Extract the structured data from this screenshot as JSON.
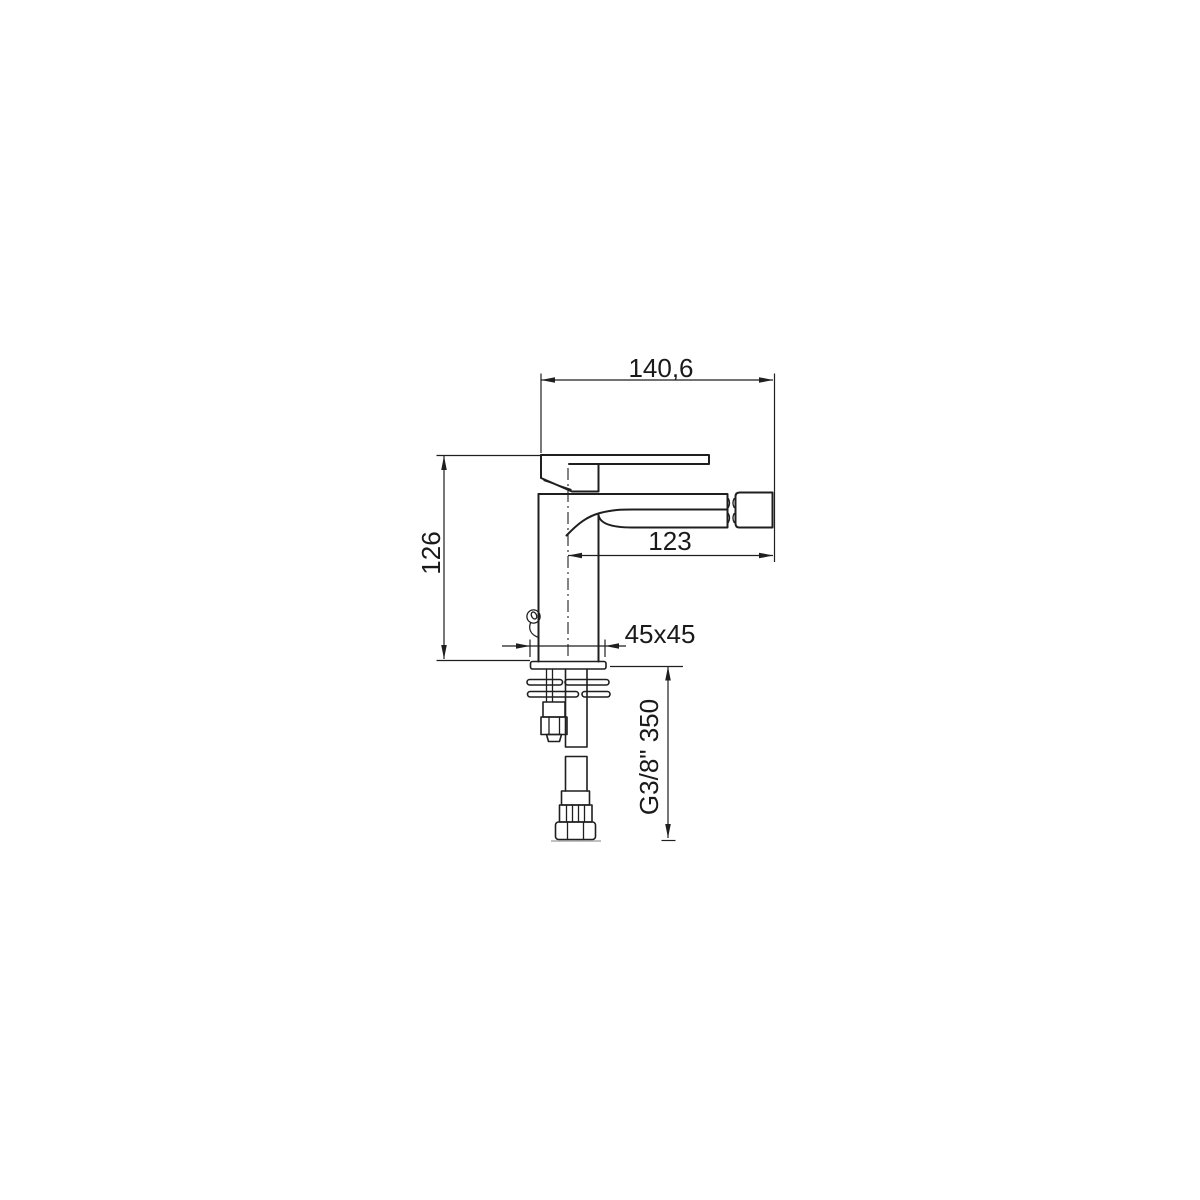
{
  "page": {
    "background": "#ffffff"
  },
  "drawing": {
    "line_color": "#1f1f1f",
    "labels": {
      "total_width": "140,6",
      "body_height": "126",
      "spout_reach": "123",
      "base_size": "45x45",
      "hose_spec": "G3/8\" 350"
    }
  }
}
